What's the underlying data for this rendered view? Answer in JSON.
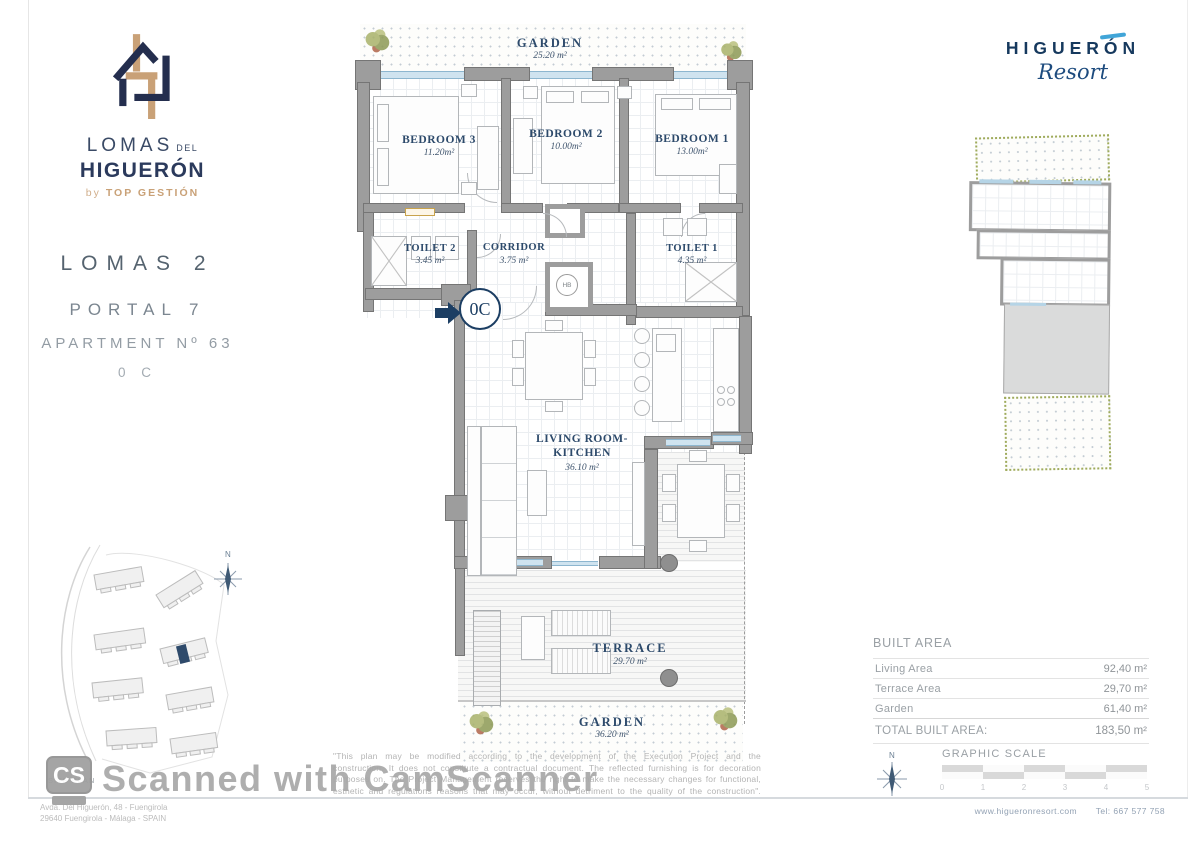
{
  "branding": {
    "lomas_logo": {
      "word1": "LOMAS",
      "word1_suffix": "DEL",
      "word2": "HIGUERÓN",
      "byline_by": "by",
      "byline_name": "TOP GESTIÓN"
    },
    "resort_logo": {
      "name": "HIGUERÓN",
      "script": "Resort"
    }
  },
  "unit_info": {
    "project": "LOMAS 2",
    "portal": "PORTAL 7",
    "apartment": "APARTMENT Nº 63",
    "unit_code": "0 C"
  },
  "floor_plan": {
    "rooms": {
      "garden_top": {
        "name": "GARDEN",
        "area": "25.20 m²"
      },
      "bedroom3": {
        "name": "BEDROOM 3",
        "area": "11.20m²"
      },
      "bedroom2": {
        "name": "BEDROOM 2",
        "area": "10.00m²"
      },
      "bedroom1": {
        "name": "BEDROOM 1",
        "area": "13.00m²"
      },
      "toilet2": {
        "name": "TOILET 2",
        "area": "3.45 m²"
      },
      "corridor": {
        "name": "CORRIDOR",
        "area": "3.75 m²"
      },
      "toilet1": {
        "name": "TOILET 1",
        "area": "4.35 m²"
      },
      "living": {
        "name_line1": "LIVING ROOM-",
        "name_line2": "KITCHEN",
        "area": "36.10 m²"
      },
      "terrace": {
        "name": "TERRACE",
        "area": "29.70 m²"
      },
      "garden_bottom": {
        "name": "GARDEN",
        "area": "36.20 m²"
      }
    },
    "entrance_badge": "0C",
    "closet_label": "HB"
  },
  "area_table": {
    "title": "BUILT AREA",
    "rows": [
      {
        "label": "Living Area",
        "value": "92,40 m²"
      },
      {
        "label": "Terrace Area",
        "value": "29,70 m²"
      },
      {
        "label": "Garden",
        "value": "61,40 m²"
      }
    ],
    "total": {
      "label": "TOTAL BUILT AREA:",
      "value": "183,50 m²"
    }
  },
  "graphic_scale": {
    "title": "GRAPHIC SCALE",
    "ticks": [
      "0",
      "1",
      "2",
      "3",
      "4",
      "5"
    ],
    "north_label": "N"
  },
  "site_plan": {
    "label": "SITE PLAN",
    "north_label": "N"
  },
  "disclaimer": {
    "lines": [
      "\"This plan may be modified according to the development of the Execution Project and the",
      "construction. It does not constitute a contractual document. The reflected furnishing is for decoration",
      "purposes on. The Project Management reserves the right to make the necessary changes for functional,",
      "esthetic and regulations reasons that may occur, without detriment to the quality of the construction\"."
    ]
  },
  "footer": {
    "address_line1": "Avda. Del Higuerón, 48 - Fuengirola",
    "address_line2": "29640 Fuengirola - Málaga - SPAIN",
    "website": "www.higueronresort.com",
    "phone": "Tel: 667 577 758"
  },
  "watermark": {
    "logo": "CS",
    "text": "Scanned with CamScanner"
  },
  "colors": {
    "brand_navy": "#243253",
    "brand_tan": "#c9a177",
    "plan_label_blue": "#2d4a6b",
    "resort_blue": "#16395e",
    "resort_accent": "#41a5d8",
    "wall_gray": "#9d9d9d",
    "window_blue": "#cfe3ef",
    "watermark_gray": "#a6a6a6"
  }
}
